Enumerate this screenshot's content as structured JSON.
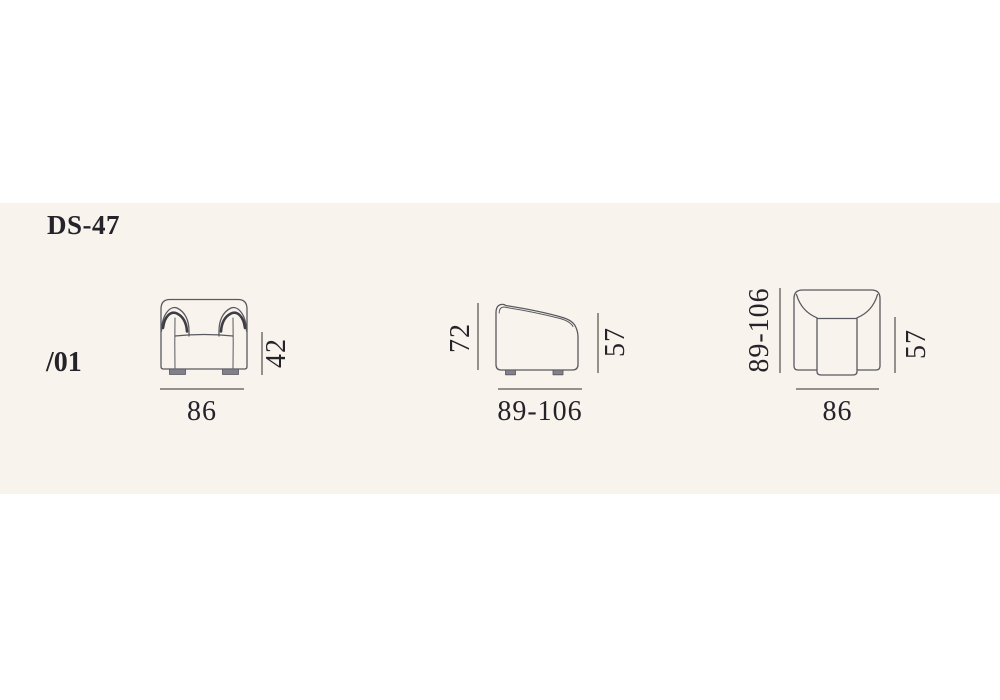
{
  "title": "DS-47",
  "variant": "/01",
  "colors": {
    "page_bg": "#ffffff",
    "band_bg": "#f8f4ed",
    "drawing_stroke": "#5a5860",
    "drawing_shadow": "#3e3d43",
    "dim_line": "#94918b",
    "text": "#25232a",
    "feet_fill": "#82808a"
  },
  "views": {
    "front": {
      "right_label": "42",
      "bottom_label": "86"
    },
    "side": {
      "left_label": "72",
      "right_label": "57",
      "bottom_label": "89-106"
    },
    "top": {
      "left_label": "89-106",
      "right_label": "57",
      "bottom_label": "86"
    }
  }
}
